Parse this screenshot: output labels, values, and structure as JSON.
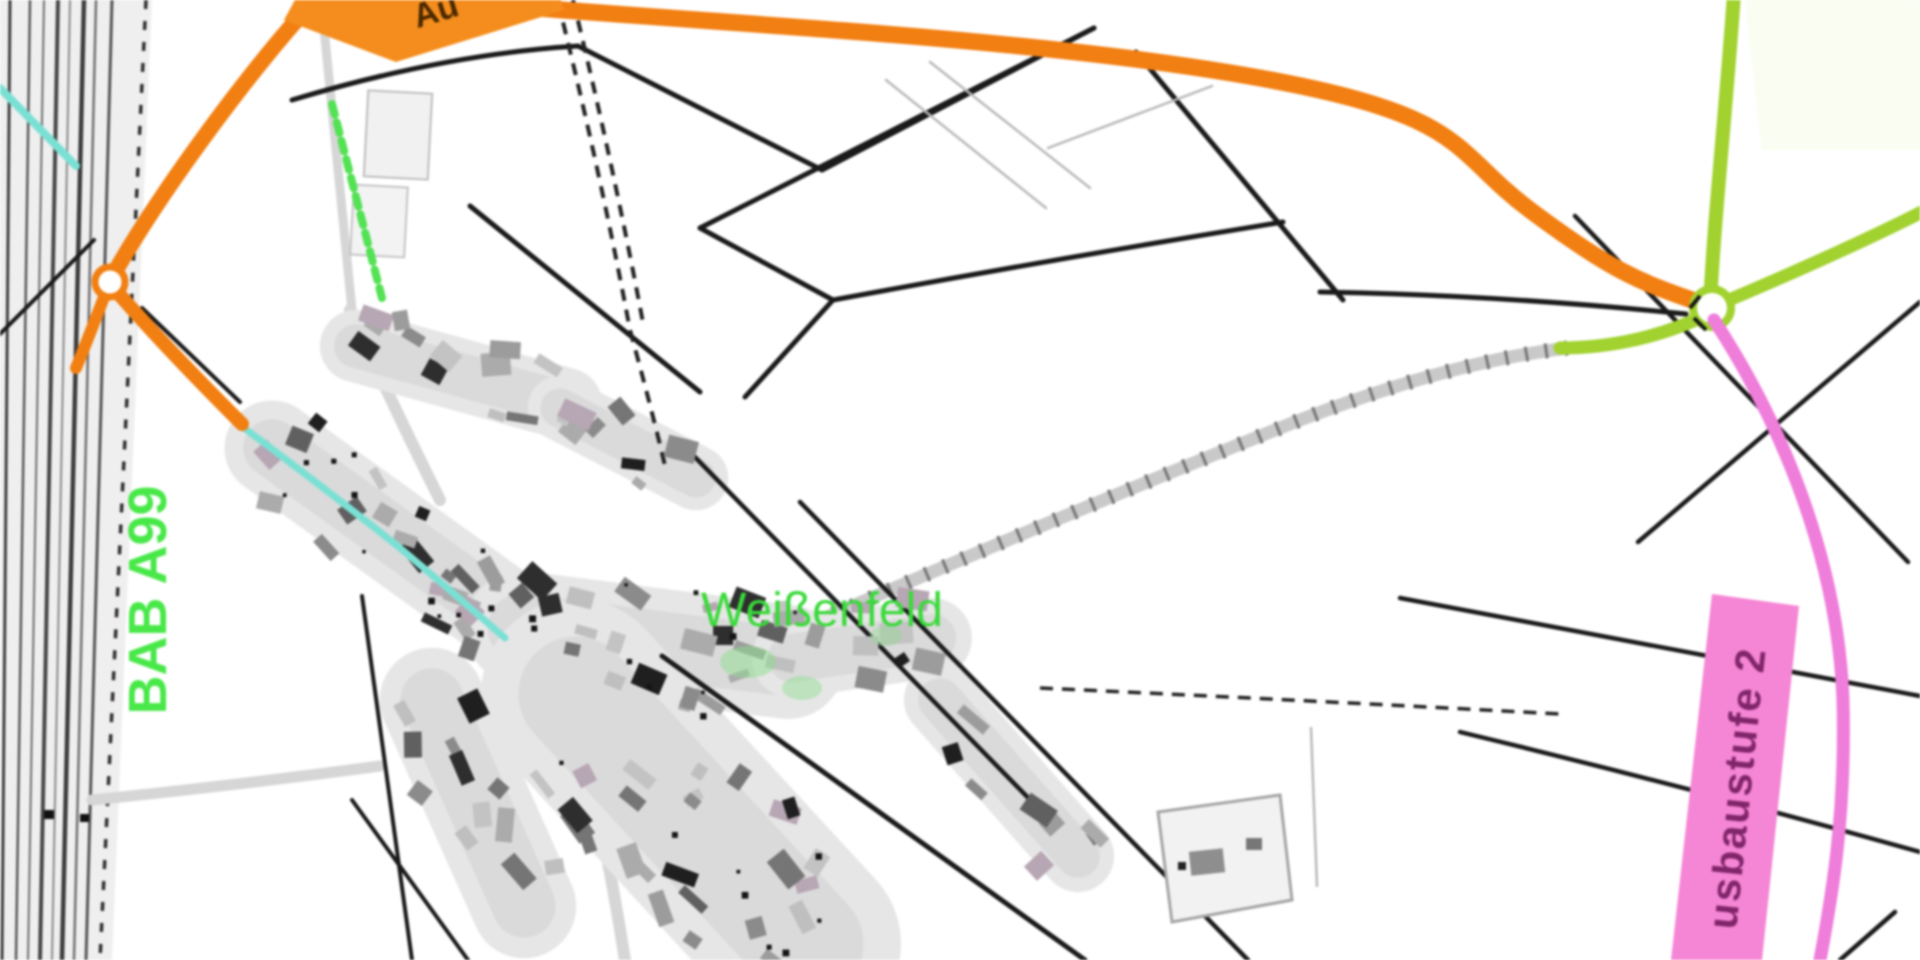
{
  "map": {
    "labels": {
      "village": "Weißenfeld",
      "motorway": "BAB A99",
      "construction_stage_2": "usbaustufe 2",
      "construction_stage_1_fragment": "Au"
    },
    "colors": {
      "orange": "#EE8017",
      "orangeLabel": "#F18E22",
      "orangeLabelText": "#4A2800",
      "lime": "#A2D134",
      "pink": "#EC7ED8",
      "pinkLabel": "#F287D3",
      "pinkText": "#7D2668",
      "greenText": "#3FD83F",
      "greenDash": "#57E057",
      "cyan": "#7EDFD4",
      "ink": "#1A1A1A",
      "roadGray": "#D6D6D6",
      "background": "#FFFFFF"
    }
  }
}
